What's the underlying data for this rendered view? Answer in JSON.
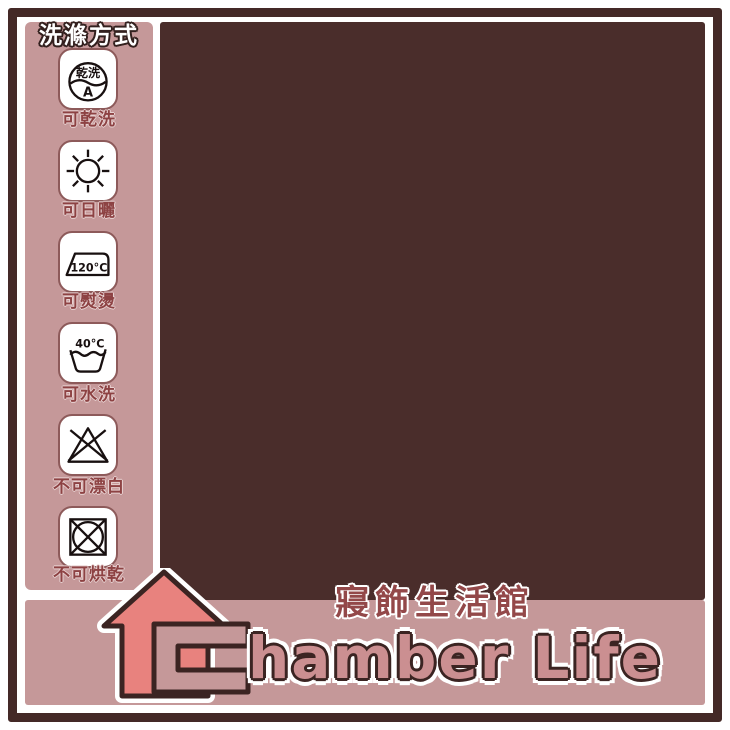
{
  "header": {
    "title": "車縫樣式尺寸參考圖"
  },
  "sidebar": {
    "title": "洗滌方式",
    "items": [
      {
        "icon": "dry-clean-icon",
        "symbol_text": "乾洗",
        "symbol_sub": "A",
        "label": "可乾洗"
      },
      {
        "icon": "sun-dry-icon",
        "label": "可日曬"
      },
      {
        "icon": "iron-icon",
        "symbol_text": "120°C",
        "label": "可熨燙"
      },
      {
        "icon": "hand-wash-icon",
        "symbol_text": "40°C",
        "label": "可水洗"
      },
      {
        "icon": "no-bleach-icon",
        "label": "不可漂白"
      },
      {
        "icon": "no-tumble-dry-icon",
        "label": "不可烘乾"
      }
    ]
  },
  "legend": {
    "front": "正面",
    "back": "背面",
    "front_color": "#a35557",
    "back_color": "#c79b9d"
  },
  "wrap": {
    "title": "包束方式"
  },
  "size_cards": [
    {
      "title": "單人3.5x6.2尺",
      "pillow_height": "45CM",
      "pillow_width": "75CM",
      "length": "186cm",
      "width": "105cm"
    },
    {
      "title": "雙人5x6.2尺",
      "pillow_height": "45CM",
      "pillow_width": "75CM",
      "length": "186cm",
      "width": "150cm"
    },
    {
      "title": "加大6x6.2尺",
      "pillow_height": "45CM",
      "pillow_width": "75CM",
      "length": "186cm",
      "width": "180cm"
    },
    {
      "title": "特大6x7尺",
      "pillow_height": "45CM",
      "pillow_width": "75CM",
      "length": "210cm",
      "width": "180cm"
    }
  ],
  "quilt_cards": [
    {
      "title": "單人二用被(被套)4.5X6.5尺",
      "length": "195CM",
      "width": "135CM"
    },
    {
      "title": "雙人二用被(被套)6X7尺",
      "length": "210CM",
      "width": "180CM"
    }
  ],
  "brand": {
    "tagline": "寢飾生活館",
    "wordmark": "hamber Life",
    "full_name": "Chamber Life"
  },
  "colors": {
    "frame": "#442927",
    "panel_dark": "#4a2d2b",
    "panel_pink": "#c59899",
    "card_pink": "#bd8b8c",
    "bed_red": "#a35557",
    "bed_border": "#5c3130",
    "pillow_shadow": "#d3abac",
    "title_salmon": "#e4837d",
    "label_maroon": "#934849",
    "measure_rose": "#c96b6d",
    "house_salmon": "#e8827e",
    "wordmark_rose": "#cb8f91"
  }
}
